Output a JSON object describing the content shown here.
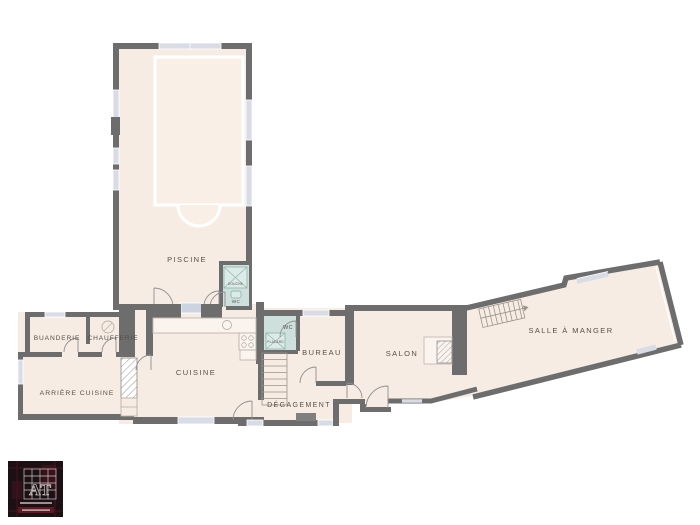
{
  "plan": {
    "rooms": {
      "piscine": "PISCINE",
      "douche": "DOUCHE",
      "wc_piscine": "WC",
      "buanderie": "BUANDERIE",
      "chaufferie": "CHAUFFERIE",
      "arriere_cuisine": "ARRIÈRE CUISINE",
      "cuisine": "CUISINE",
      "wc": "WC",
      "placard": "PLACARD",
      "bureau": "BUREAU",
      "degagement": "DÉGAGEMENT",
      "salon": "SALON",
      "salle_a_manger": "SALLE À MANGER"
    },
    "colors": {
      "floor": "#f7ece3",
      "wall": "#6d6d6d",
      "window": "#d8dce7",
      "wet_room": "#cde0db",
      "label_text": "#575049"
    },
    "logo": {
      "monogram": "AT"
    }
  }
}
